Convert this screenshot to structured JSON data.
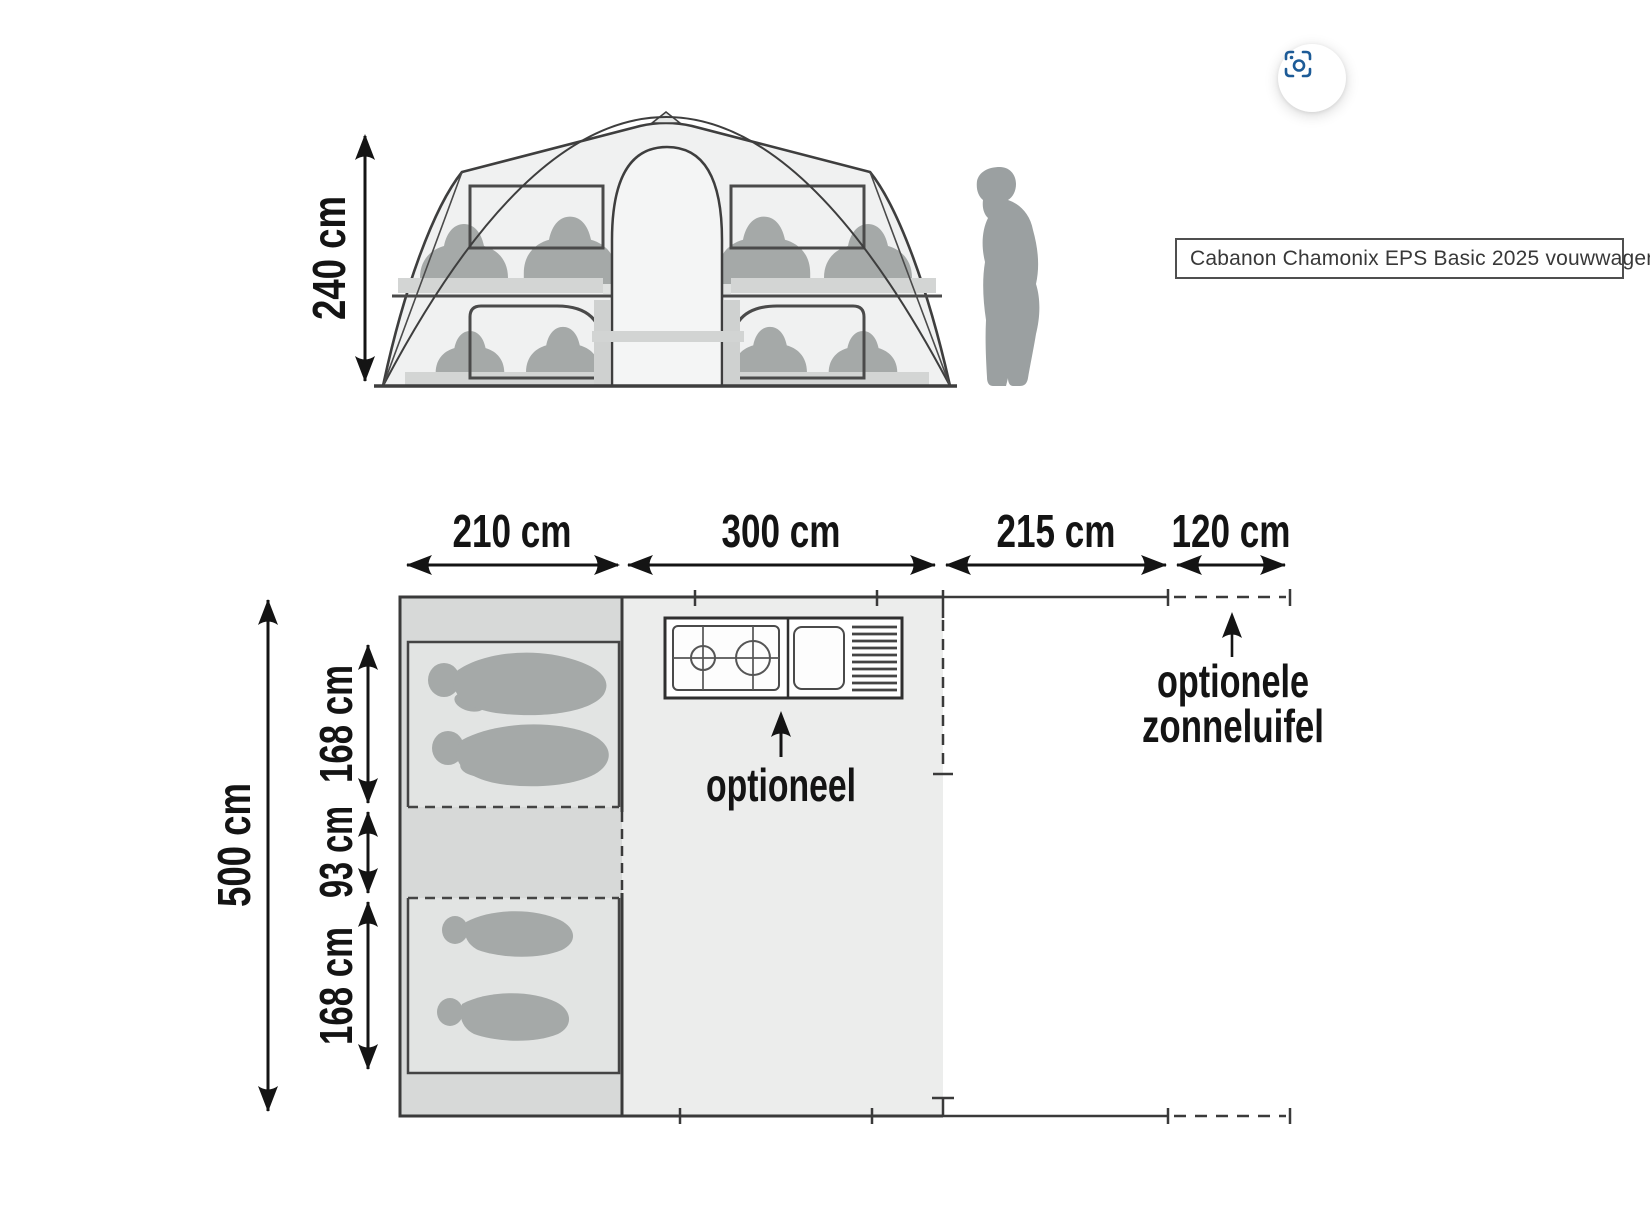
{
  "page": {
    "caption": "Cabanon Chamonix EPS Basic 2025 vouwwagen"
  },
  "toolbar": {
    "visual_search_icon": "visual-search-camera-icon",
    "icon_color": "#1d5b97"
  },
  "elevation": {
    "height_label": "240 cm"
  },
  "plan": {
    "width_labels": [
      "210 cm",
      "300 cm",
      "215 cm",
      "120 cm"
    ],
    "depth_label": "500 cm",
    "section_labels": [
      "168 cm",
      "93 cm",
      "168 cm"
    ],
    "kitchen_note": "optioneel",
    "awning_note_line1": "optionele",
    "awning_note_line2": "zonneluifel"
  },
  "colors": {
    "ink": "#141414",
    "wall_line": "#3a3a3a",
    "bedroom_fill": "#d7d9d8",
    "bed_fill": "#e2e4e3",
    "main_fill": "#ecedec",
    "tent_fill": "#f0f1f1",
    "figure_fill": "#a5a9a8",
    "accent_blue": "#1d5b97"
  }
}
